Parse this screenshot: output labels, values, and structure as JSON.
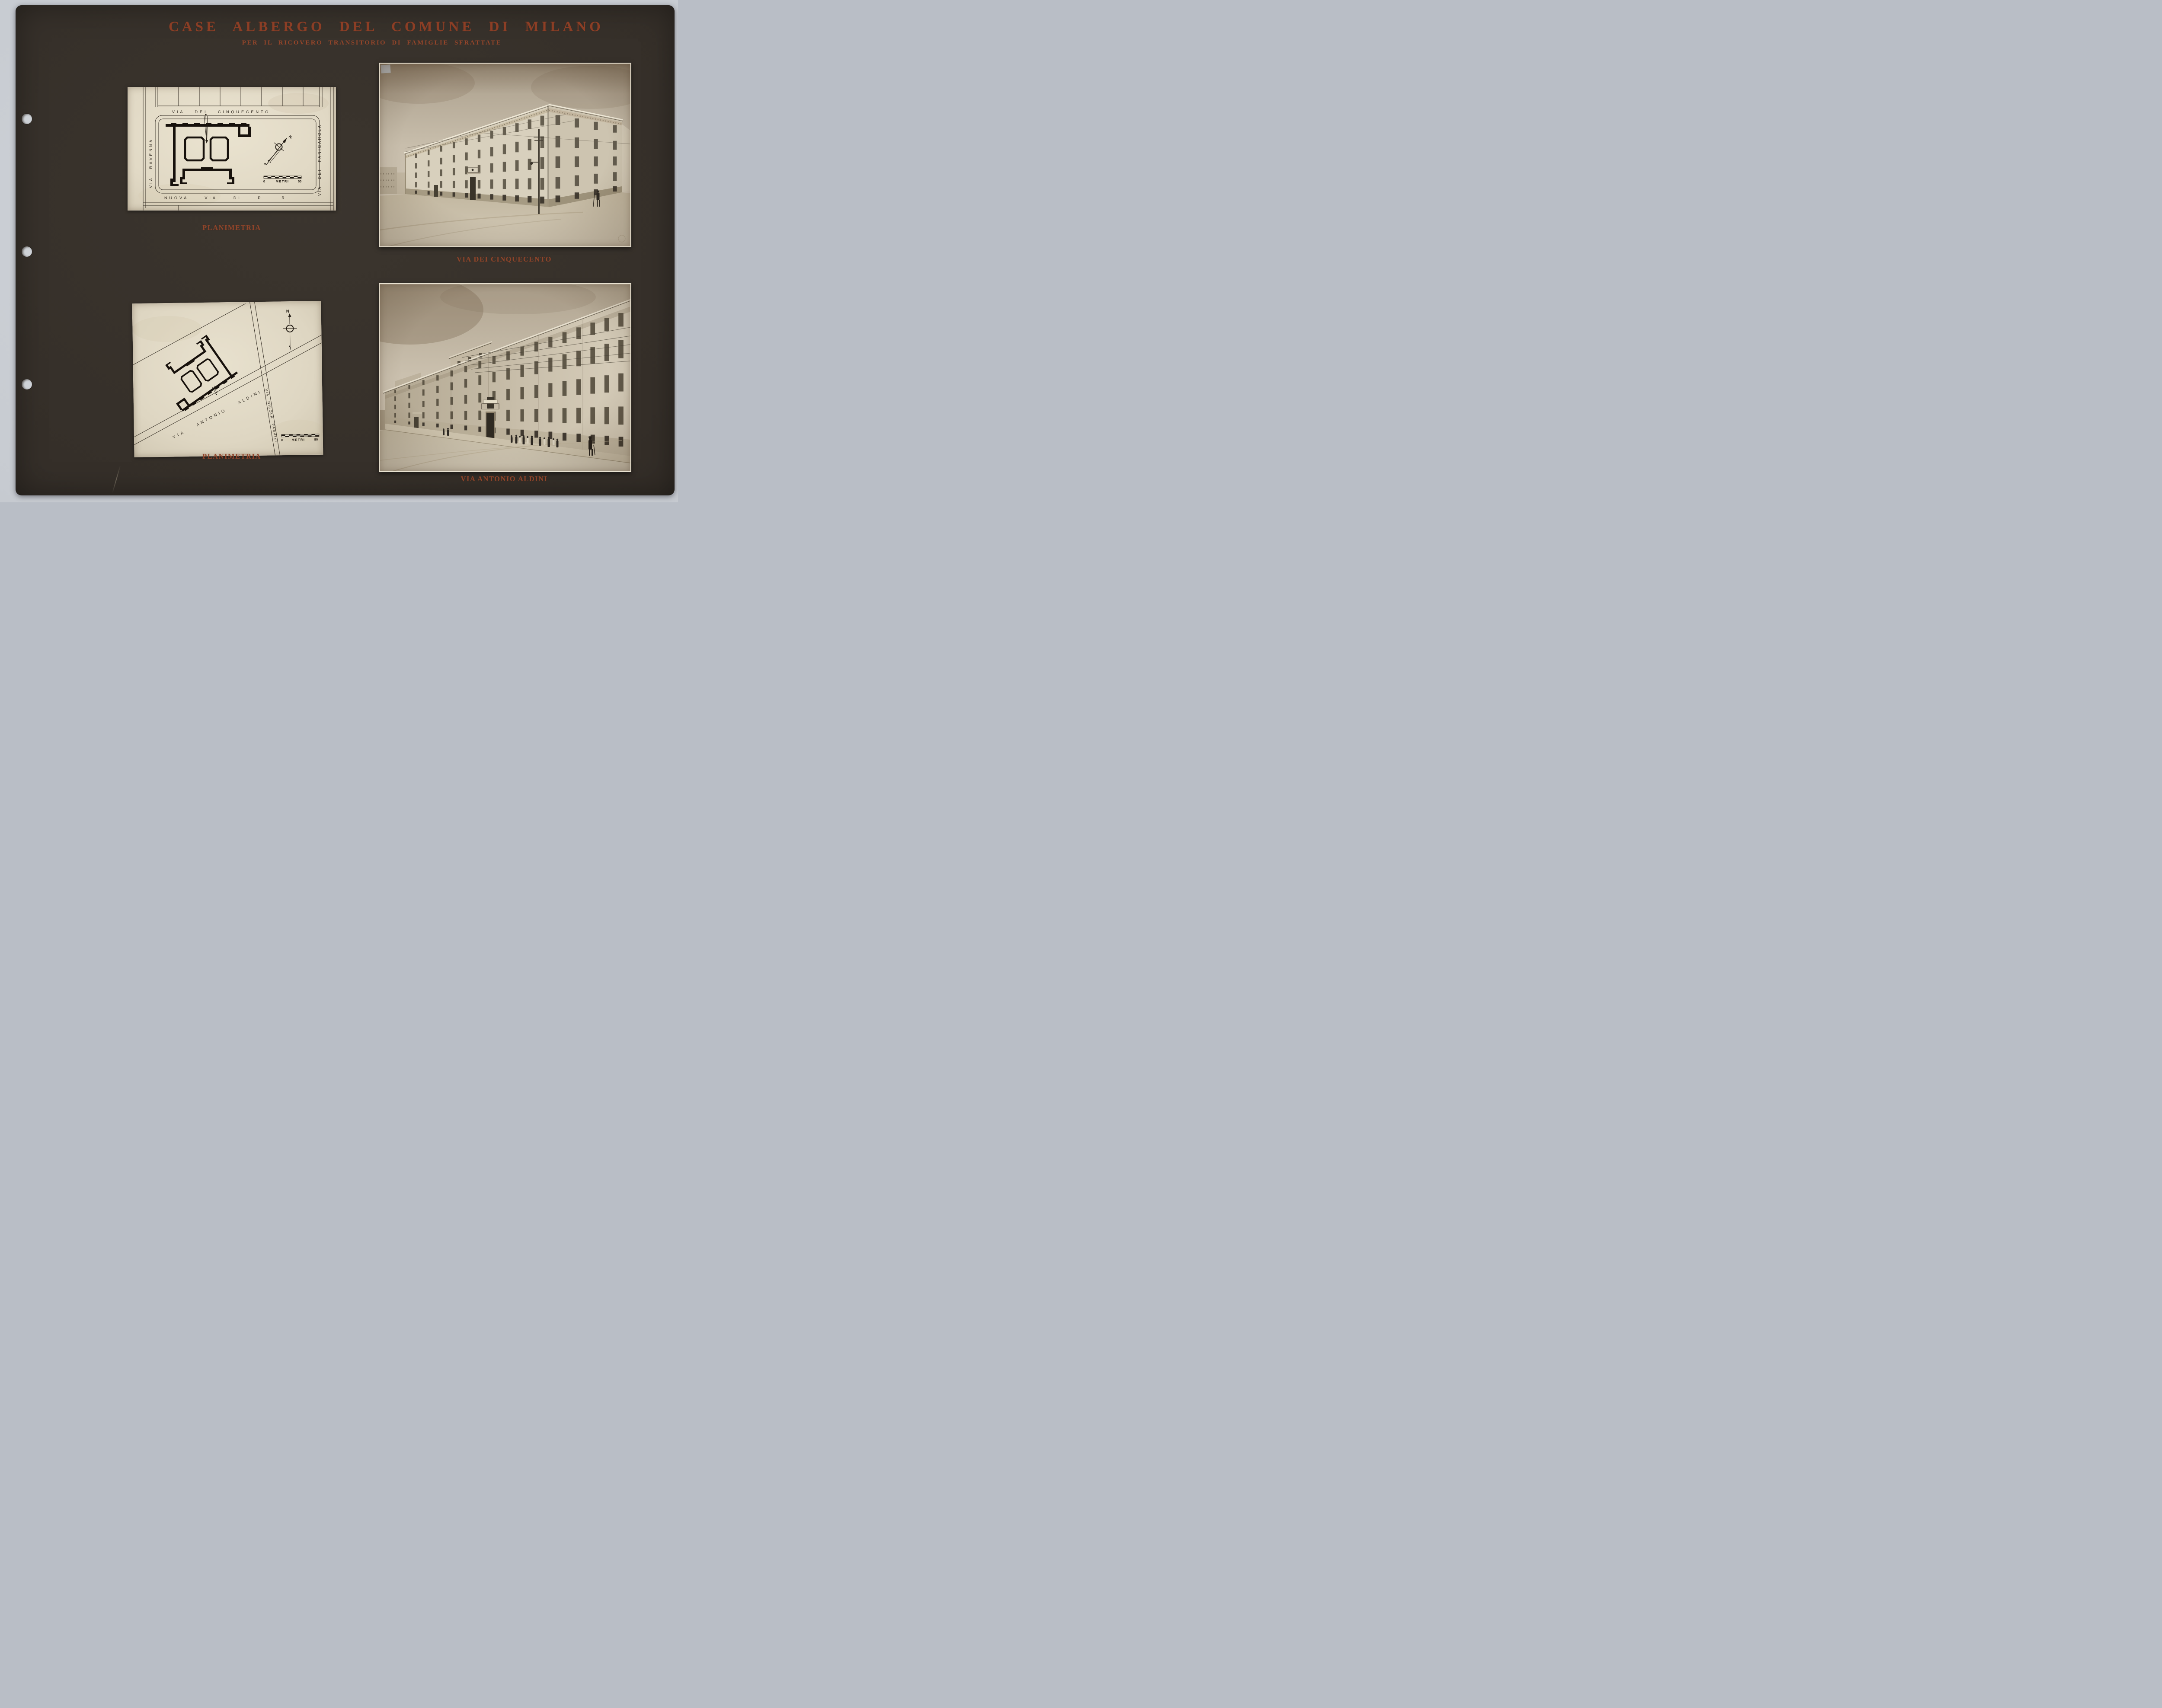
{
  "page": {
    "title": "CASE ALBERGO DEL COMUNE DI MILANO",
    "subtitle": "PER IL RICOVERO TRANSITORIO DI FAMIGLIE SFRATTATE"
  },
  "colors": {
    "backing": "#c6cad0",
    "album_page": "#352f29",
    "accent_red": "#8c3e25",
    "plan_paper": "#e2dbc7",
    "photo_sepia": "#cfc5b2",
    "ink": "#1b150f"
  },
  "plan_top": {
    "caption": "PLANIMETRIA",
    "street_top": "VIA DEI CINQUECENTO",
    "street_left": "VIA RAVENNA",
    "street_right": "VIA DEI PANIGAROLA",
    "street_bottom": "NUOVA VIA DI P. R.",
    "compass_label": "N.",
    "scale_zero": "0",
    "scale_unit": "METRI",
    "scale_max": "50"
  },
  "photo_top": {
    "caption": "VIA DEI CINQUECENTO"
  },
  "plan_bottom": {
    "caption": "PLANIMETRIA",
    "street_main": "VIA ANTONIO ALDINI",
    "street_side": "VIA NICOLA FABRIZI",
    "compass_label": "N",
    "scale_zero": "0",
    "scale_unit": "METRI",
    "scale_max": "50"
  },
  "photo_bottom": {
    "caption": "VIA ANTONIO ALDINI"
  }
}
